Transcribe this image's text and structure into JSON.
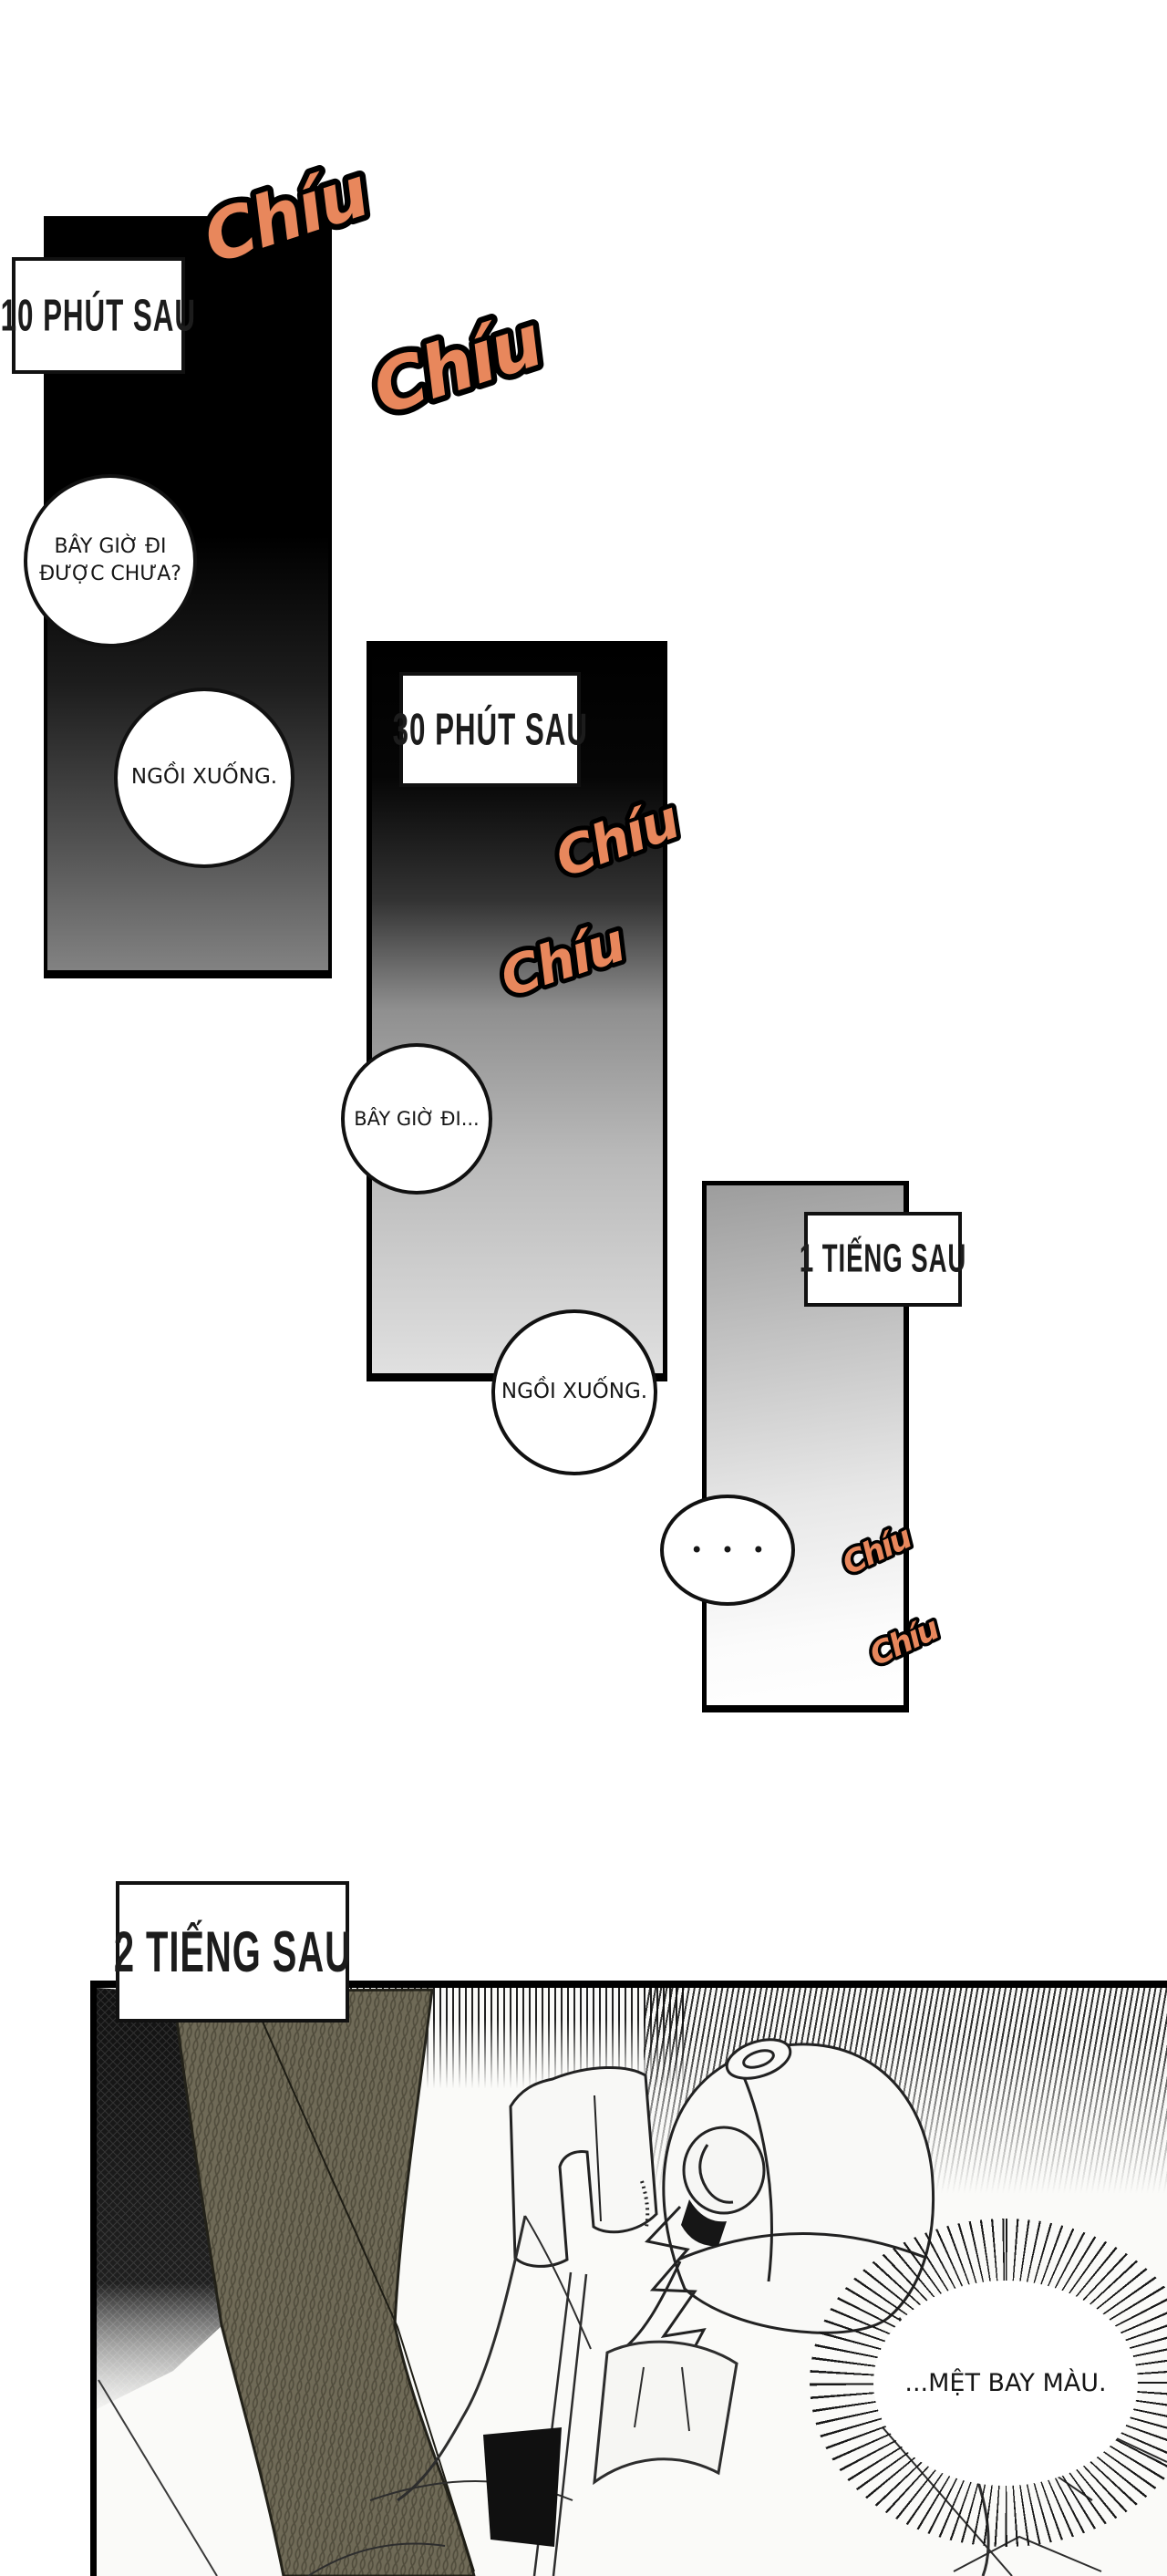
{
  "page": {
    "sfx_text": "Chíu",
    "sfx_color": "#e8875c",
    "knit_band_color": "#6f6a57",
    "background_color": "#ffffff"
  },
  "panel1": {
    "time_label": "10 PHÚT SAU",
    "bubble_question_line1": "BÂY GIỜ ĐI",
    "bubble_question_line2": "ĐƯỢC CHƯA?",
    "bubble_answer": "NGỒI XUỐNG."
  },
  "panel2": {
    "time_label": "30 PHÚT SAU",
    "bubble_question": "BÂY GIỜ ĐI...",
    "bubble_answer": "NGỒI XUỐNG."
  },
  "panel3": {
    "time_label": "1 TIẾNG SAU",
    "bubble_dots": "• • •"
  },
  "panel4": {
    "time_label": "2 TIẾNG SAU",
    "bubble_speech": "...MỆT BAY MÀU."
  }
}
